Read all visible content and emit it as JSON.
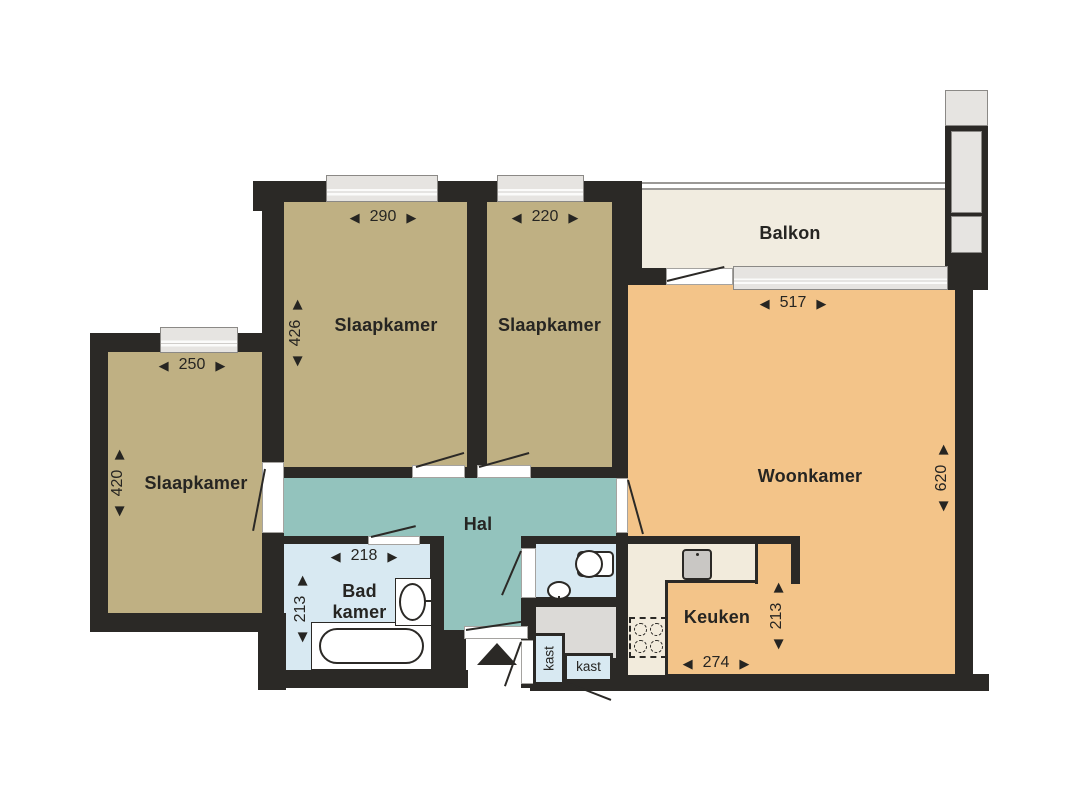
{
  "plan_title": "apartment-floorplan",
  "rooms": {
    "bedroom_top_left": {
      "label": "Slaapkamer",
      "dim_width": "290",
      "dim_height": "426"
    },
    "bedroom_top_right": {
      "label": "Slaapkamer",
      "dim_width": "220"
    },
    "bedroom_left": {
      "label": "Slaapkamer",
      "dim_width": "250",
      "dim_height": "420"
    },
    "living_room": {
      "label": "Woonkamer",
      "dim_width": "517",
      "dim_height": "620"
    },
    "balcony": {
      "label": "Balkon"
    },
    "hall": {
      "label": "Hal"
    },
    "bathroom": {
      "label_line1": "Bad",
      "label_line2": "kamer",
      "dim_width": "218",
      "dim_height": "213"
    },
    "kitchen": {
      "label": "Keuken",
      "dim_width": "274",
      "dim_height": "213"
    },
    "closet_hall": {
      "label": "kast"
    },
    "closet_entry": {
      "label": "kast"
    }
  },
  "icons": {
    "arrow_left": "◀",
    "arrow_right": "▶"
  },
  "colors": {
    "wall": "#2b2926",
    "bedroom_floor": "#bfb083",
    "living_floor": "#f3c489",
    "hall_floor": "#93c3bd",
    "bath_floor": "#d8e9f2",
    "balcony_floor": "#f1ece0",
    "counter": "#f2ebdc",
    "storage_floor": "#dcdad7",
    "window": "#e6e4e1"
  }
}
